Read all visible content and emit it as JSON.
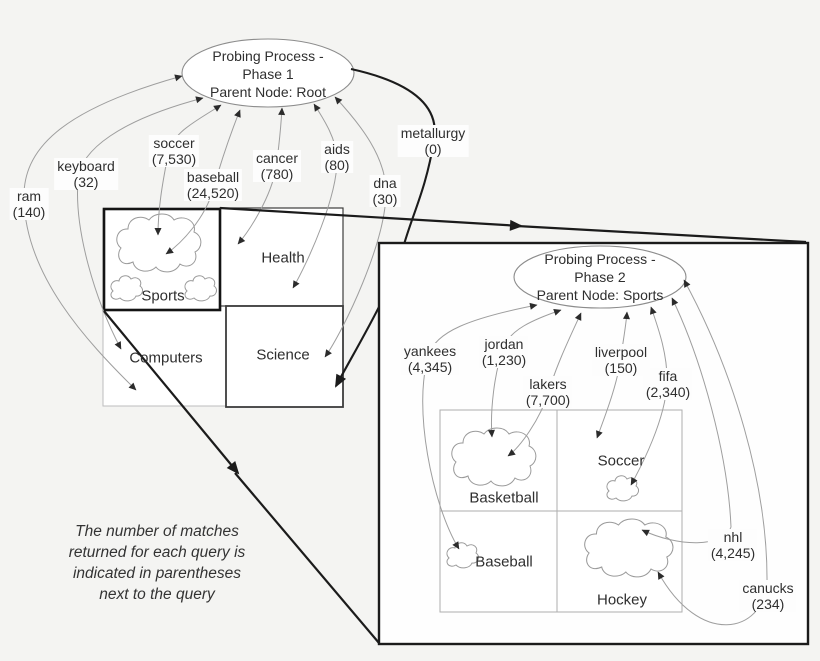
{
  "note": {
    "text": "The number of matches returned for each query is indicated in parentheses next to the query"
  },
  "phase1": {
    "ellipse": {
      "line1": "Probing Process -",
      "line2": "Phase 1",
      "line3": "Parent Node: Root"
    },
    "queries": [
      {
        "name": "ram",
        "count": "(140)"
      },
      {
        "name": "keyboard",
        "count": "(32)"
      },
      {
        "name": "soccer",
        "count": "(7,530)"
      },
      {
        "name": "baseball",
        "count": "(24,520)"
      },
      {
        "name": "cancer",
        "count": "(780)"
      },
      {
        "name": "aids",
        "count": "(80)"
      },
      {
        "name": "dna",
        "count": "(30)"
      },
      {
        "name": "metallurgy",
        "count": "(0)"
      }
    ],
    "categories": {
      "topLeft": "Sports",
      "topRight": "Health",
      "bottomLeft": "Computers",
      "bottomRight": "Science"
    }
  },
  "phase2": {
    "ellipse": {
      "line1": "Probing Process -",
      "line2": "Phase 2",
      "line3": "Parent Node: Sports"
    },
    "queries": [
      {
        "name": "yankees",
        "count": "(4,345)"
      },
      {
        "name": "jordan",
        "count": "(1,230)"
      },
      {
        "name": "lakers",
        "count": "(7,700)"
      },
      {
        "name": "liverpool",
        "count": "(150)"
      },
      {
        "name": "fifa",
        "count": "(2,340)"
      },
      {
        "name": "nhl",
        "count": "(4,245)"
      },
      {
        "name": "canucks",
        "count": "(234)"
      }
    ],
    "categories": {
      "topLeft": "Basketball",
      "topRight": "Soccer",
      "bottomLeft": "Baseball",
      "bottomRight": "Hockey"
    }
  },
  "colors": {
    "background": "#f4f4f2",
    "ink": "#2f2f2f",
    "thin_line": "#9e9e9e",
    "bold_line": "#1b1b1b"
  }
}
